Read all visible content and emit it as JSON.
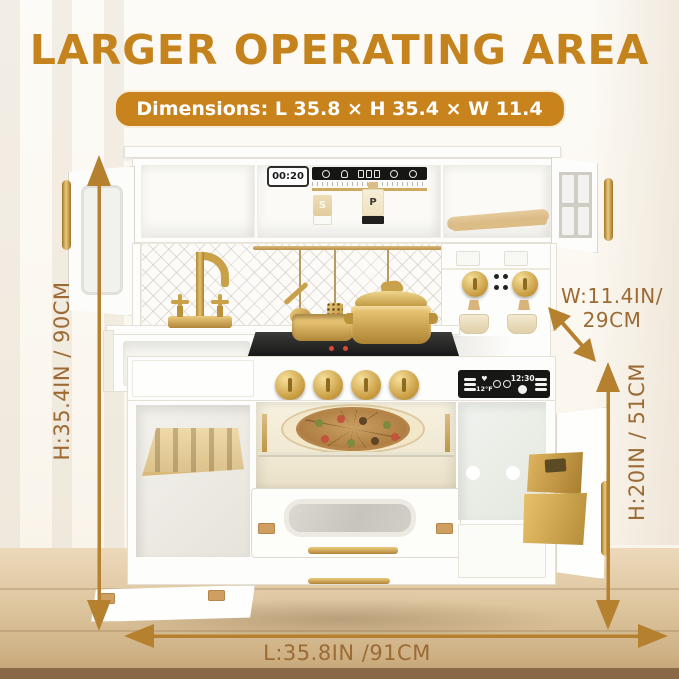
{
  "header": {
    "title": "LARGER OPERATING AREA",
    "dimensions_badge": "Dimensions: L 35.8 × H 35.4 × W 11.4"
  },
  "annotations": {
    "height_overall": "H:35.4IN / 90CM",
    "width_line1": "W:11.4IN/",
    "width_line2": "29CM",
    "height_lower": "H:20IN / 51CM",
    "length": "L:35.8IN /91CM"
  },
  "kitchen": {
    "clock_display": "00:20",
    "salt_shaker_label": "S",
    "pepper_grinder_label": "P",
    "oven_display_time": "12:30",
    "oven_display_temp": "12°F",
    "heart_glyph": "♥",
    "control_strip_icons": [
      "power-icon",
      "chef-icon",
      "switch-buttons-icon",
      "plate-icon",
      "alarm-clock-icon"
    ],
    "oven_display_icons": [
      "heart-icon",
      "mitt-icon",
      "mitt-icon",
      "clock-icon"
    ]
  },
  "colors": {
    "title_orange": "#c5831d",
    "badge_orange": "#c8831c",
    "annotation_brown": "#9c6a33",
    "arrow_gold": "#b5812f",
    "hardware_gold": "#c9a149",
    "wood_tan": "#e3cda1",
    "panel_black": "#171715",
    "floor_wood": "#d4b88e"
  }
}
